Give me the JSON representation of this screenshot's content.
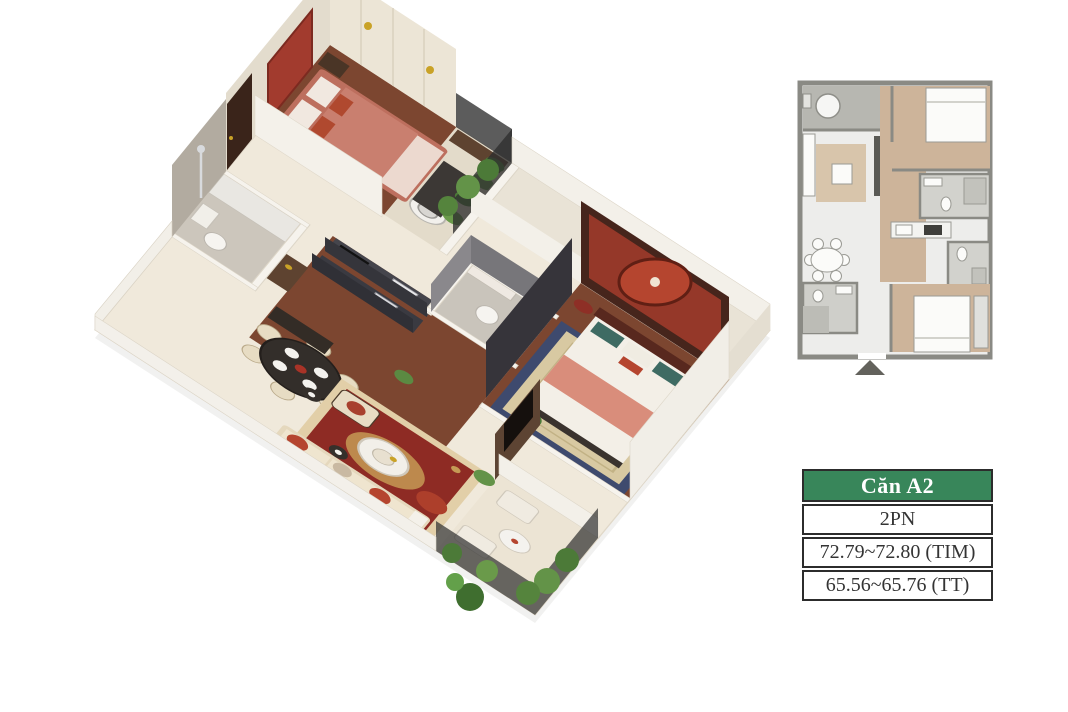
{
  "unit_table": {
    "header": "Căn A2",
    "rows": [
      {
        "label": "2PN"
      },
      {
        "label": "72.79~72.80 (TIM)"
      },
      {
        "label": "65.56~65.76 (TT)"
      }
    ]
  },
  "plan_2d": {
    "entrance_marker": "up-triangle-icon"
  },
  "colors": {
    "table_header_green": "#38865a",
    "table_border": "#2c2c2c",
    "rug_red": "#8e2b24",
    "terracotta_bed": "#c4786a",
    "headboard_red": "#a23b2e",
    "wood_floor": "#7c4630",
    "wall_cream": "#ece5d6",
    "navy_rug_border": "#3e4a6e",
    "plant_green": "#4c7a38",
    "railing_dark": "#2e2e2e",
    "plan_wall_gray": "#8a8a84",
    "plan_wood": "#cdb49a"
  }
}
